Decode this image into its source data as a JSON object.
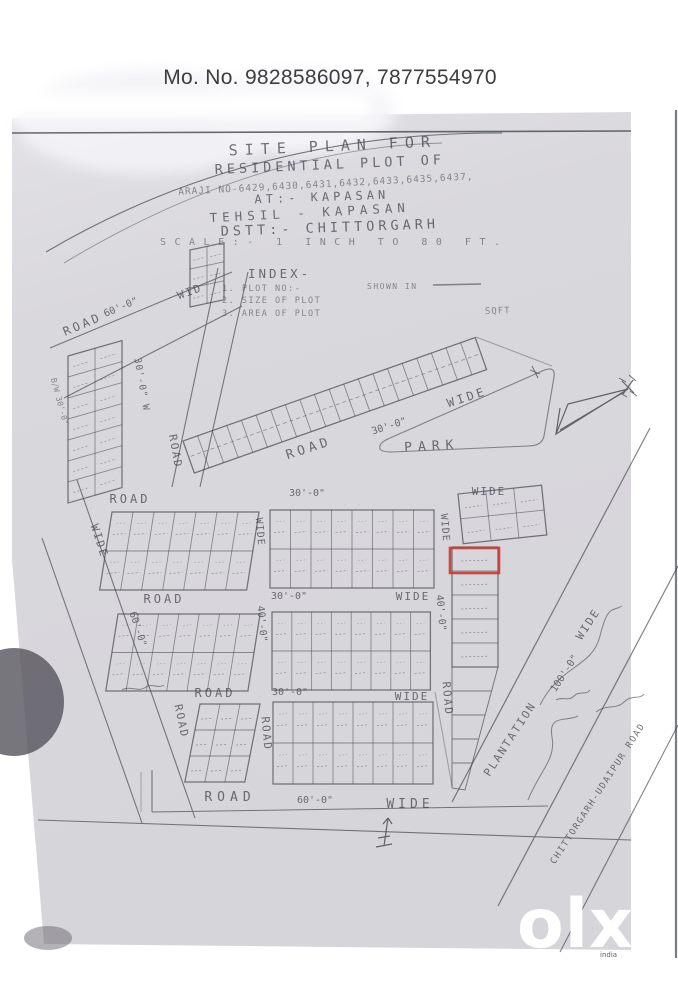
{
  "header": {
    "phone": "Mo. No. 9828586097, 7877554970"
  },
  "plan": {
    "title": {
      "line1": "SITE PLAN FOR",
      "line2": "RESIDENTIAL PLOT OF",
      "line3": "ARAJI NO-6429,6430,6431,6432,6433,6435,6437,",
      "line4": "AT:- KAPASAN",
      "line5": "TEHSIL - KAPASAN",
      "line6": "DSTT:- CHITTORGARH",
      "line7": "SCALE:- 1 INCH TO 80 FT."
    },
    "index": {
      "heading": "INDEX-",
      "item1": "1. PLOT NO:-",
      "item1b": "SHOWN IN",
      "item2": "2. SIZE OF PLOT",
      "item3": "3. AREA OF PLOT",
      "unit": "SQFT"
    },
    "labels": {
      "road": "ROAD",
      "wide": "WIDE",
      "wid": "WID",
      "d30": "30'-0\"",
      "d30w": "30'-0\" W",
      "d40": "40'-0\"",
      "d60": "60'-0\"",
      "d100": "100'-0\"",
      "bw30": "B/W 30'-0\"",
      "park": "PARK",
      "plantation": "PLANTATION",
      "highway": "CHITTORGARH-UDAIPUR ROAD"
    },
    "highlight": {
      "color": "#c63a30"
    }
  },
  "watermark": {
    "brand": "olx",
    "country": "india",
    "color": "#ffffff"
  }
}
